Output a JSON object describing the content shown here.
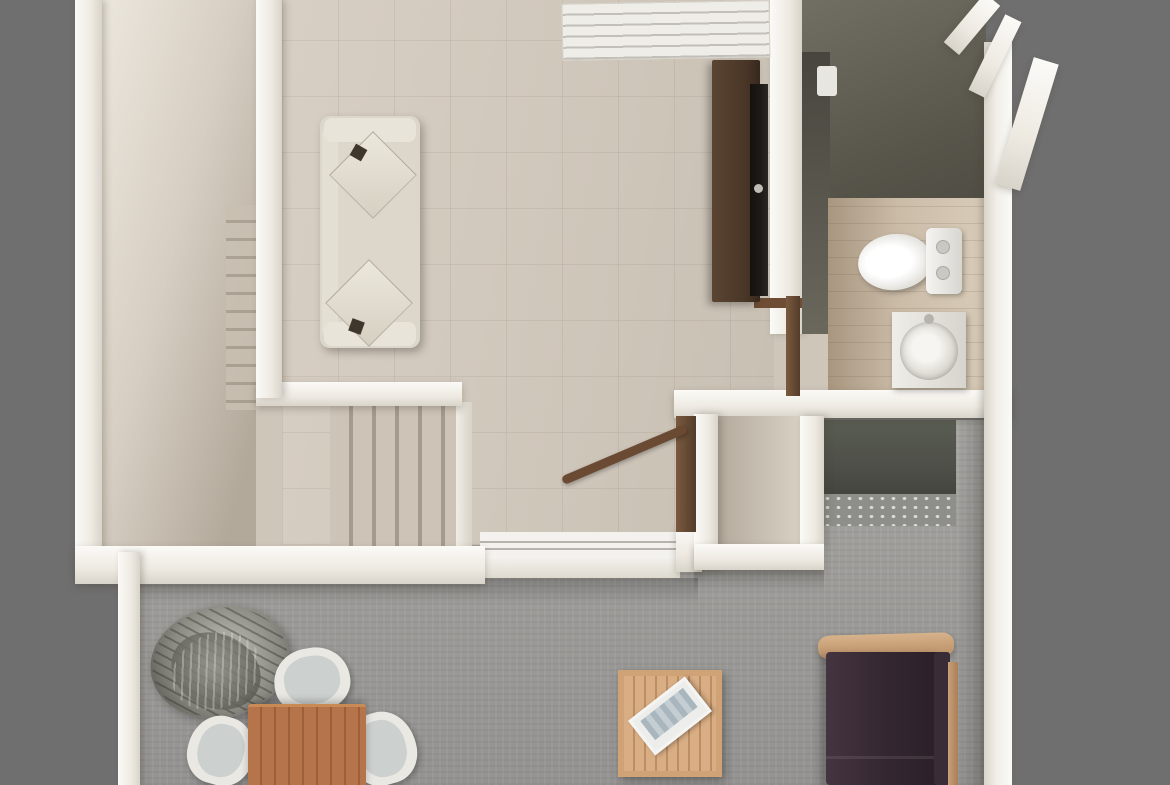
{
  "scene": {
    "description": "Top-down 3D architectural render of a small two-level apartment floor plan on a plain gray background",
    "view": "top-down 3D render",
    "upper_level_rooms": [
      "entry hall with staircase",
      "living room",
      "bathroom",
      "stairwell to lower level"
    ],
    "lower_level_rooms": [
      "terrace lounge with dining area"
    ]
  },
  "items": {
    "hall": "entry hall with staircase",
    "livingRoom": "living room",
    "bathroom": "bathroom",
    "stairwell": "stairwell to lower level",
    "terrace": "lower terrace",
    "sofa": "cream fabric sofa with cushions",
    "tv": "TV on dark media cabinet",
    "window": "louvered window",
    "slidingDoor": "sliding glass door",
    "toilet": "toilet",
    "vanity": "washbasin vanity",
    "handrail": "wooden stair handrail",
    "plant": "potted plant",
    "diningTable": "wooden dining table",
    "chair": "dining chair",
    "coffeeTable": "slatted wooden coffee table with tray",
    "outdoorSofa": "plum outdoor sofa with wood frame",
    "privacyPanel": "dark privacy panel",
    "pebbles": "pebble strip"
  },
  "palette": {
    "background": "#6f6f6f",
    "wall": "#fbfaf7",
    "floorHall": "#d6cec2",
    "floorLiving": "#cfc6ba",
    "floorBath": "#cbbca8",
    "floorTerrace": "#9d9c99",
    "darkZone": "#57544a",
    "cabinetWood": "#4a3627",
    "tvScreen": "#1d1a17",
    "railWood": "#533d2a",
    "sofaCream": "#ddd7cb",
    "cushionCream": "#e9e4d9",
    "plumSofa": "#332630",
    "sofaFrameWood": "#c8a178",
    "chairWhite": "#e9e8e3",
    "chairSeat": "#ccd0ce",
    "tableWood": "#b5744a",
    "coffeeWood": "#d9ae85",
    "plantGray": "#8a8a82",
    "panelDark": "#4e5049",
    "pebbleGray": "#8e8e8a",
    "stepDark": "#a59b8d"
  }
}
